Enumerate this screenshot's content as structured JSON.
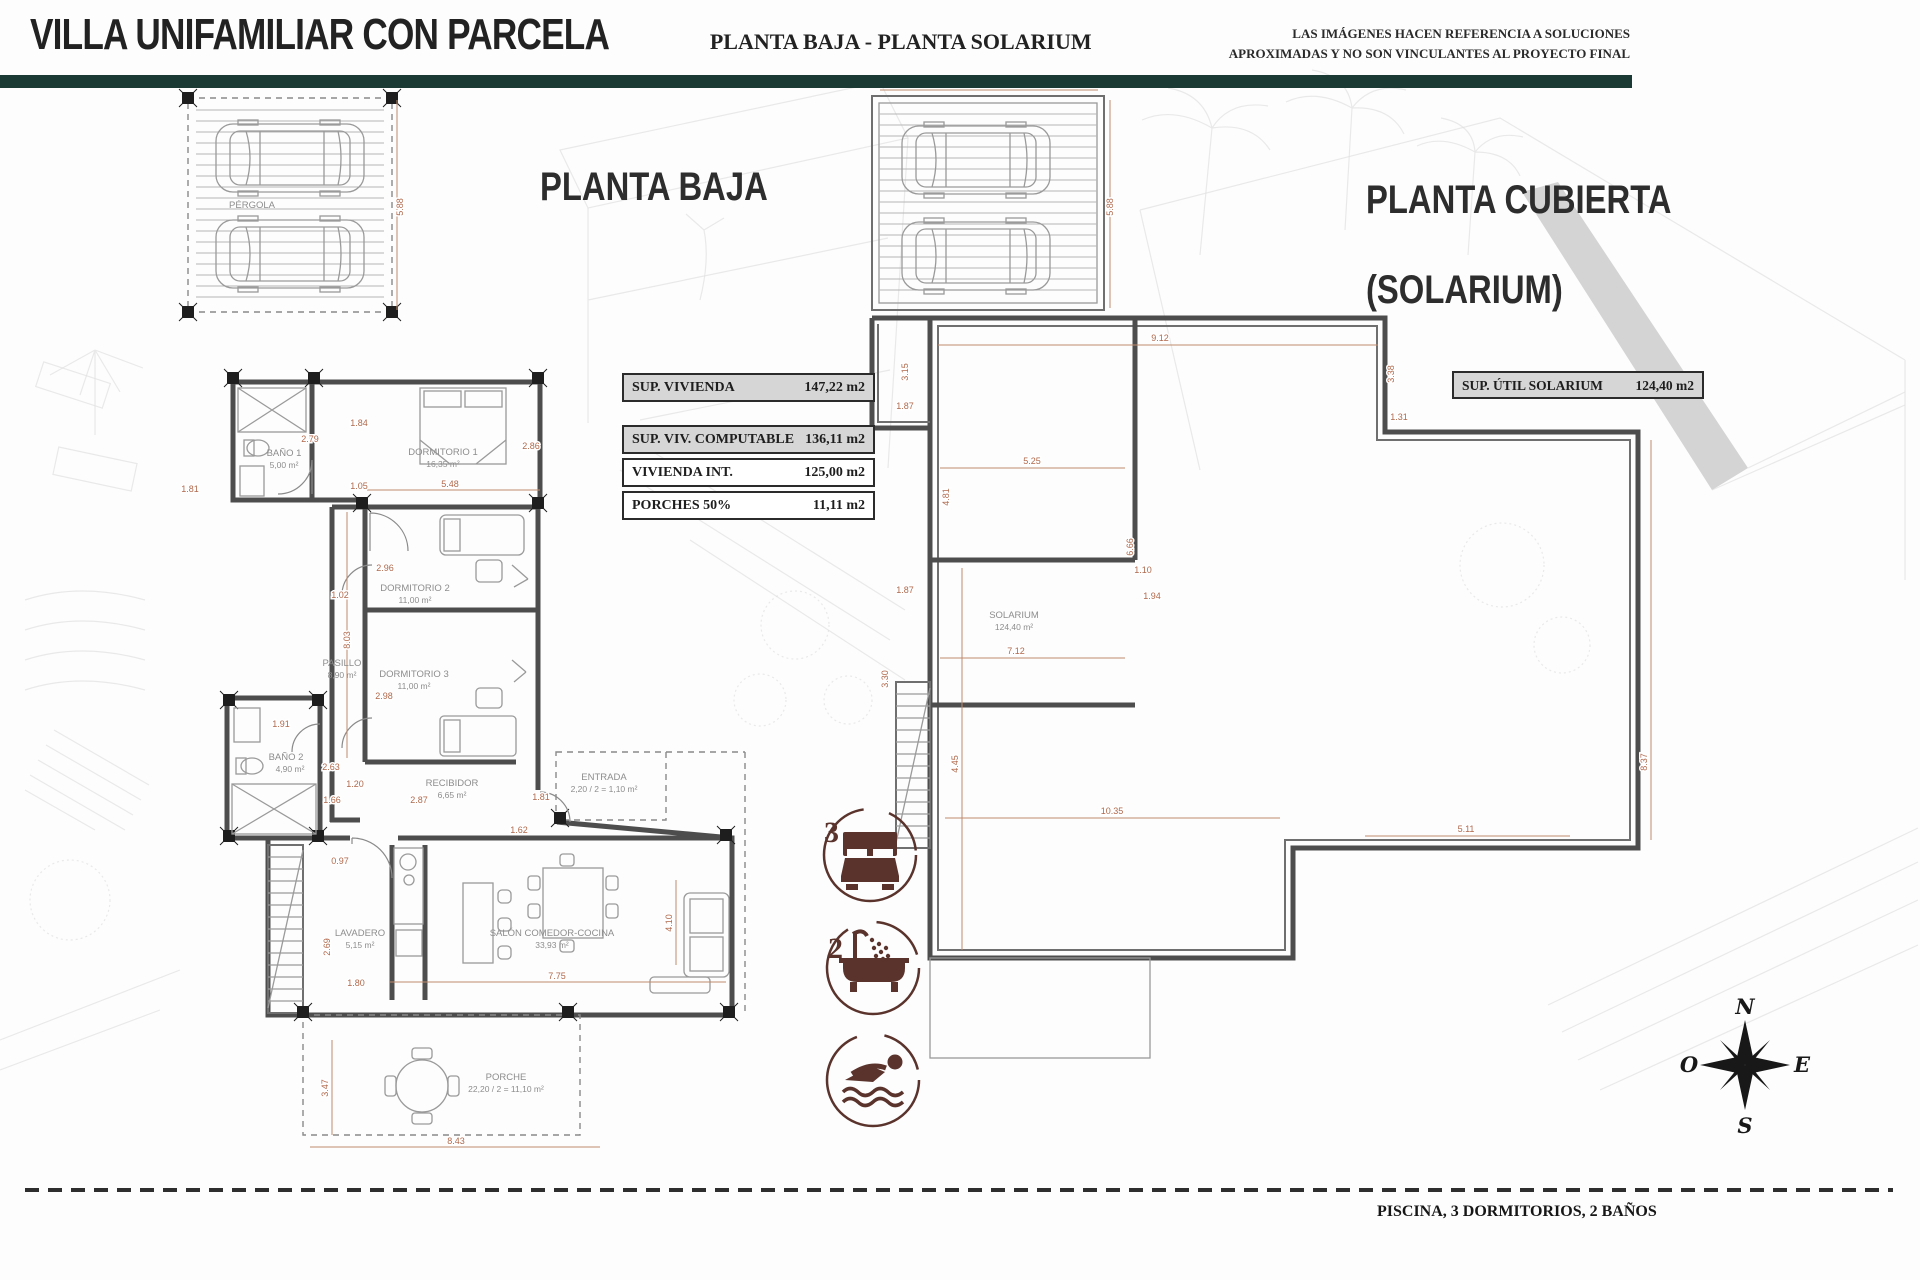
{
  "header": {
    "title": "VILLA UNIFAMILIAR CON PARCELA",
    "subtitle": "PLANTA BAJA - PLANTA SOLARIUM",
    "disclaimer_line1": "LAS IMÁGENES HACEN REFERENCIA A SOLUCIONES",
    "disclaimer_line2": "APROXIMADAS Y NO SON VINCULANTES AL PROYECTO FINAL"
  },
  "colors": {
    "accent_bar": "#1b3a33",
    "dimension_text": "#b0694c",
    "icon_maroon": "#5a332c"
  },
  "planta_baja": {
    "title": "PLANTA BAJA",
    "pergola_label": "PÉRGOLA",
    "area_table": [
      {
        "label": "SUP. VIVIENDA",
        "value": "147,22 m2"
      },
      {
        "label": "SUP. VIV. COMPUTABLE",
        "value": "136,11 m2"
      },
      {
        "label": "VIVIENDA INT.",
        "value": "125,00 m2"
      },
      {
        "label": "PORCHES 50%",
        "value": "11,11 m2"
      }
    ],
    "rooms": [
      {
        "name": "BAÑO 1",
        "area": "5,00 m²"
      },
      {
        "name": "DORMITORIO 1",
        "area": "16,35 m²"
      },
      {
        "name": "DORMITORIO 2",
        "area": "11,00 m²"
      },
      {
        "name": "DORMITORIO 3",
        "area": "11,00 m²"
      },
      {
        "name": "PASILLO",
        "area": "8,90 m²"
      },
      {
        "name": "BAÑO 2",
        "area": "4,90 m²"
      },
      {
        "name": "RECIBIDOR",
        "area": "6,65 m²"
      },
      {
        "name": "ENTRADA",
        "area": "2,20 / 2 = 1,10 m²"
      },
      {
        "name": "LAVADERO",
        "area": "5,15 m²"
      },
      {
        "name": "SALÓN COMEDOR-COCINA",
        "area": "33,93 m²"
      },
      {
        "name": "PORCHE",
        "area": "22,20 / 2 = 11,10 m²"
      }
    ],
    "dimensions": [
      "5.88",
      "2.79",
      "1.81",
      "1.84",
      "1.05",
      "5.48",
      "2.86",
      "2.96",
      "1.02",
      "8.03",
      "2.98",
      "1.91",
      "2.63",
      "1.20",
      "2.87",
      "1.66",
      "1.81",
      "1.62",
      "0.97",
      "2.69",
      "1.80",
      "7.75",
      "4.10",
      "3.47",
      "8.43"
    ]
  },
  "planta_cubierta": {
    "title_line1": "PLANTA CUBIERTA",
    "title_line2": "(SOLARIUM)",
    "area_label": "SUP. ÚTIL SOLARIUM",
    "area_value": "124,40 m2",
    "room_label": "SOLARIUM",
    "room_area": "124,40 m²",
    "dimensions": [
      "5.84",
      "5.88",
      "9.12",
      "3.15",
      "3.38",
      "1.87",
      "1.31",
      "5.25",
      "4.81",
      "6.66",
      "1.10",
      "1.94",
      "7.12",
      "3.30",
      "5.11",
      "8.37",
      "4.45",
      "10.35"
    ]
  },
  "badges": {
    "bedrooms": "3",
    "bathrooms": "2"
  },
  "compass": {
    "north": "N",
    "east": "E",
    "south": "S",
    "west": "O"
  },
  "footer": {
    "summary": "PISCINA, 3 DORMITORIOS, 2 BAÑOS"
  }
}
